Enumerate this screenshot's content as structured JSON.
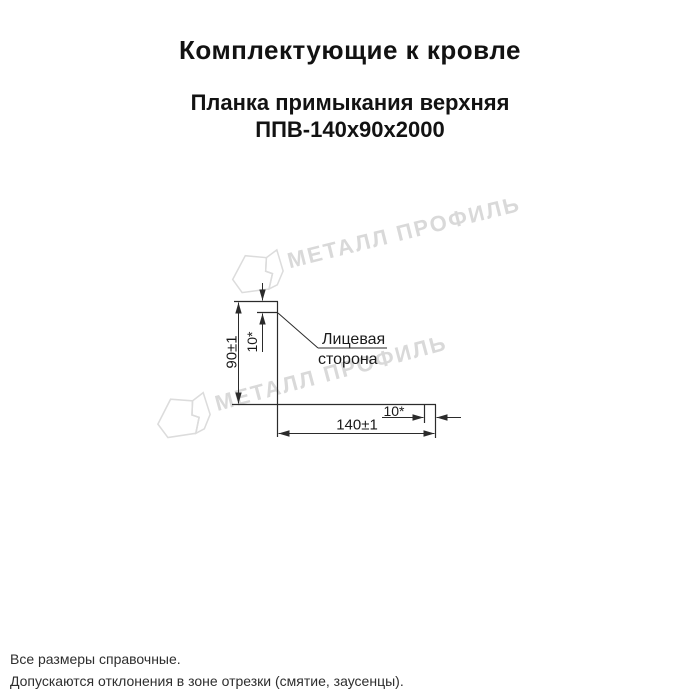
{
  "header": {
    "title": "Комплектующие к кровле",
    "product_line1": "Планка примыкания верхняя",
    "product_line2": "ППВ-140х90х2000"
  },
  "drawing": {
    "dim_height": "90±1",
    "dim_top_hem": "10*",
    "dim_bottom_width": "140±1",
    "dim_end_hem": "10*",
    "face_line1": "Лицевая",
    "face_line2": "сторона"
  },
  "watermark": {
    "text": "МЕТАЛЛ ПРОФИЛЬ",
    "color": "#d9d9d9"
  },
  "footer": {
    "note1": "Все размеры справочные.",
    "note2": "Допускаются отклонения в зоне отрезки (смятие, заусенцы)."
  },
  "colors": {
    "line": "#2b2b2b",
    "text": "#111111",
    "watermark": "#d9d9d9",
    "background": "#ffffff"
  }
}
